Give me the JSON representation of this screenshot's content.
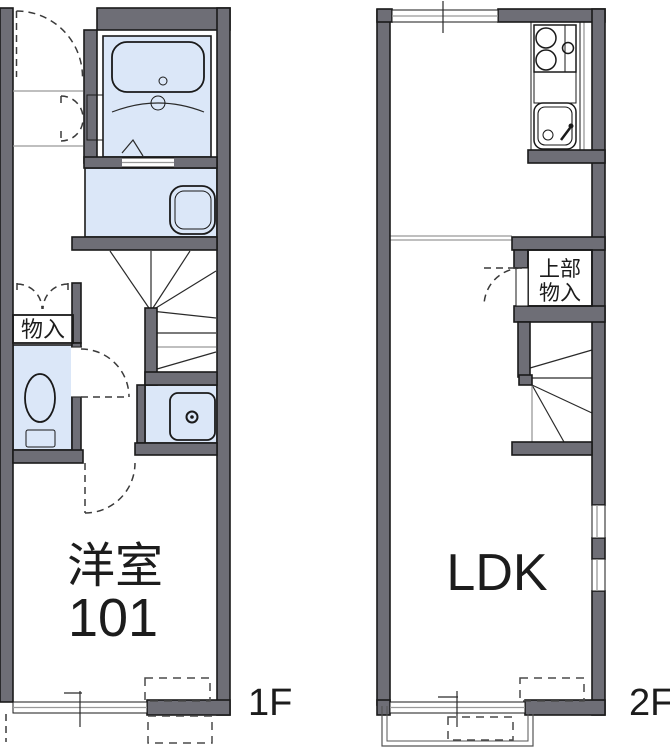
{
  "colors": {
    "wall": "#6e6e76",
    "fixture": "#dbe7f8",
    "fixture_light": "#eef5fd",
    "closet": "#f9ecd4",
    "line": "#1a1a1a",
    "background": "#ffffff"
  },
  "floor1": {
    "floor_label": "1F",
    "room_label_line1": "洋室",
    "room_label_line2": "101",
    "storage_label": "物入"
  },
  "floor2": {
    "floor_label": "2F",
    "room_label": "LDK",
    "upper_storage_line1": "上部",
    "upper_storage_line2": "物入"
  }
}
